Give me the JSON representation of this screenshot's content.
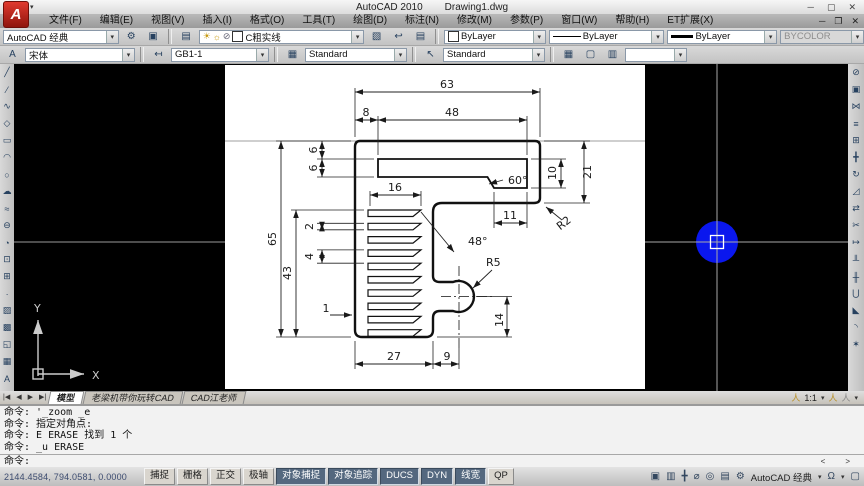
{
  "titlebar": {
    "app": "AutoCAD 2010",
    "doc": "Drawing1.dwg"
  },
  "icons": {
    "logo": "A",
    "dropdown": "▾",
    "min": "─",
    "max": "▢",
    "close": "✕",
    "restore": "❐",
    "gear": "⚙",
    "monitor": "▣",
    "layers": "▤",
    "layer-states": "▧",
    "layer-prev": "↩",
    "bulb": "☀",
    "sun": "☼",
    "lock-small": "⊘",
    "text-style": "A",
    "dim-style": "↤",
    "table-style": "▦",
    "mleader-style": "↖",
    "tab-first": "|◀",
    "tab-prev": "◀",
    "tab-next": "▶",
    "tab-last": "▶|",
    "annot-person": "人",
    "cmd-left": "<",
    "cmd-right": ">",
    "model": "▣",
    "layout": "▥",
    "pan": "╋",
    "zoom": "⌀",
    "steering-wheel": "◎",
    "showmotion": "▤",
    "workspace-gear": "⚙",
    "lock": "Ω",
    "clean-screen": "▢"
  },
  "menubar": {
    "items": [
      "文件(F)",
      "编辑(E)",
      "视图(V)",
      "插入(I)",
      "格式(O)",
      "工具(T)",
      "绘图(D)",
      "标注(N)",
      "修改(M)",
      "参数(P)",
      "窗口(W)",
      "帮助(H)",
      "ET扩展(X)"
    ]
  },
  "toolbars": {
    "workspace": "AutoCAD 经典",
    "layer": "C粗实线",
    "color": "ByLayer",
    "linetype": "ByLayer",
    "lineweight": "ByLayer",
    "plotstyle": "BYCOLOR",
    "textstyle": "宋体",
    "dimstyle": "GB1-1",
    "tablestyle": "Standard",
    "mleaderstyle": "Standard"
  },
  "draw_toolbar": [
    {
      "name": "line-tool",
      "glyph": "╱"
    },
    {
      "name": "construction-line-tool",
      "glyph": "⁄"
    },
    {
      "name": "polyline-tool",
      "glyph": "∿"
    },
    {
      "name": "polygon-tool",
      "glyph": "◇"
    },
    {
      "name": "rectangle-tool",
      "glyph": "▭"
    },
    {
      "name": "arc-tool",
      "glyph": "◠"
    },
    {
      "name": "circle-tool",
      "glyph": "○"
    },
    {
      "name": "revision-cloud-tool",
      "glyph": "☁"
    },
    {
      "name": "spline-tool",
      "glyph": "≈"
    },
    {
      "name": "ellipse-tool",
      "glyph": "⊖"
    },
    {
      "name": "ellipse-arc-tool",
      "glyph": "◔"
    },
    {
      "name": "insert-block-tool",
      "glyph": "⊡"
    },
    {
      "name": "make-block-tool",
      "glyph": "⊞"
    },
    {
      "name": "point-tool",
      "glyph": "∙"
    },
    {
      "name": "hatch-tool",
      "glyph": "▨"
    },
    {
      "name": "gradient-tool",
      "glyph": "▩"
    },
    {
      "name": "region-tool",
      "glyph": "◱"
    },
    {
      "name": "table-tool",
      "glyph": "▦"
    },
    {
      "name": "multiline-text-tool",
      "glyph": "A"
    }
  ],
  "modify_toolbar": [
    {
      "name": "erase-tool",
      "glyph": "⊘"
    },
    {
      "name": "copy-tool",
      "glyph": "▣"
    },
    {
      "name": "mirror-tool",
      "glyph": "⋈"
    },
    {
      "name": "offset-tool",
      "glyph": "≡"
    },
    {
      "name": "array-tool",
      "glyph": "⊞"
    },
    {
      "name": "move-tool",
      "glyph": "╋"
    },
    {
      "name": "rotate-tool",
      "glyph": "↻"
    },
    {
      "name": "scale-tool",
      "glyph": "◿"
    },
    {
      "name": "stretch-tool",
      "glyph": "⇄"
    },
    {
      "name": "trim-tool",
      "glyph": "✂"
    },
    {
      "name": "extend-tool",
      "glyph": "↦"
    },
    {
      "name": "break-at-point-tool",
      "glyph": "╨"
    },
    {
      "name": "break-tool",
      "glyph": "╫"
    },
    {
      "name": "join-tool",
      "glyph": "⋃"
    },
    {
      "name": "chamfer-tool",
      "glyph": "◣"
    },
    {
      "name": "fillet-tool",
      "glyph": "◝"
    },
    {
      "name": "explode-tool",
      "glyph": "✶"
    }
  ],
  "drawing": {
    "dims": {
      "total_width": "63",
      "top_offset": "8",
      "slot_width": "48",
      "t1": "6",
      "t2": "6",
      "height": "65",
      "comb_height": "43",
      "slat_width": "16",
      "slat_gap": "2",
      "slat_pitch": "4",
      "slat_last": "1",
      "angle60": "60°",
      "slot_right_h": "10",
      "bar_h": "21",
      "r2": "R2",
      "d11": "11",
      "angle48": "48°",
      "r5": "R5",
      "d14": "14",
      "bottom_w": "27",
      "d9": "9"
    },
    "ucs": {
      "x": "X",
      "y": "Y"
    }
  },
  "tabs": {
    "nav": [
      "|◀",
      "◀",
      "▶",
      "▶|"
    ],
    "items": [
      "模型",
      "老梁机带你玩转CAD",
      "CAD江老师"
    ]
  },
  "annotation": {
    "scale": "1:1"
  },
  "command": {
    "history": [
      "命令: '_zoom _e",
      "命令: 指定对角点:",
      "命令: E ERASE 找到 1 个",
      "命令: _u ERASE"
    ],
    "prompt": "命令:"
  },
  "statusbar": {
    "coords": "2144.4584, 794.0581, 0.0000",
    "toggles": [
      {
        "label": "捕捉",
        "on": false
      },
      {
        "label": "栅格",
        "on": false
      },
      {
        "label": "正交",
        "on": false
      },
      {
        "label": "极轴",
        "on": false
      },
      {
        "label": "对象捕捉",
        "on": true
      },
      {
        "label": "对象追踪",
        "on": true
      },
      {
        "label": "DUCS",
        "on": true
      },
      {
        "label": "DYN",
        "on": true
      },
      {
        "label": "线宽",
        "on": true
      },
      {
        "label": "QP",
        "on": false
      }
    ],
    "workspace": "AutoCAD 经典"
  },
  "colors": {
    "cursor": "#0a17ee",
    "paper": "#ffffff",
    "crosshair": "#a8a8a8",
    "accent_red": "#c0392b"
  }
}
